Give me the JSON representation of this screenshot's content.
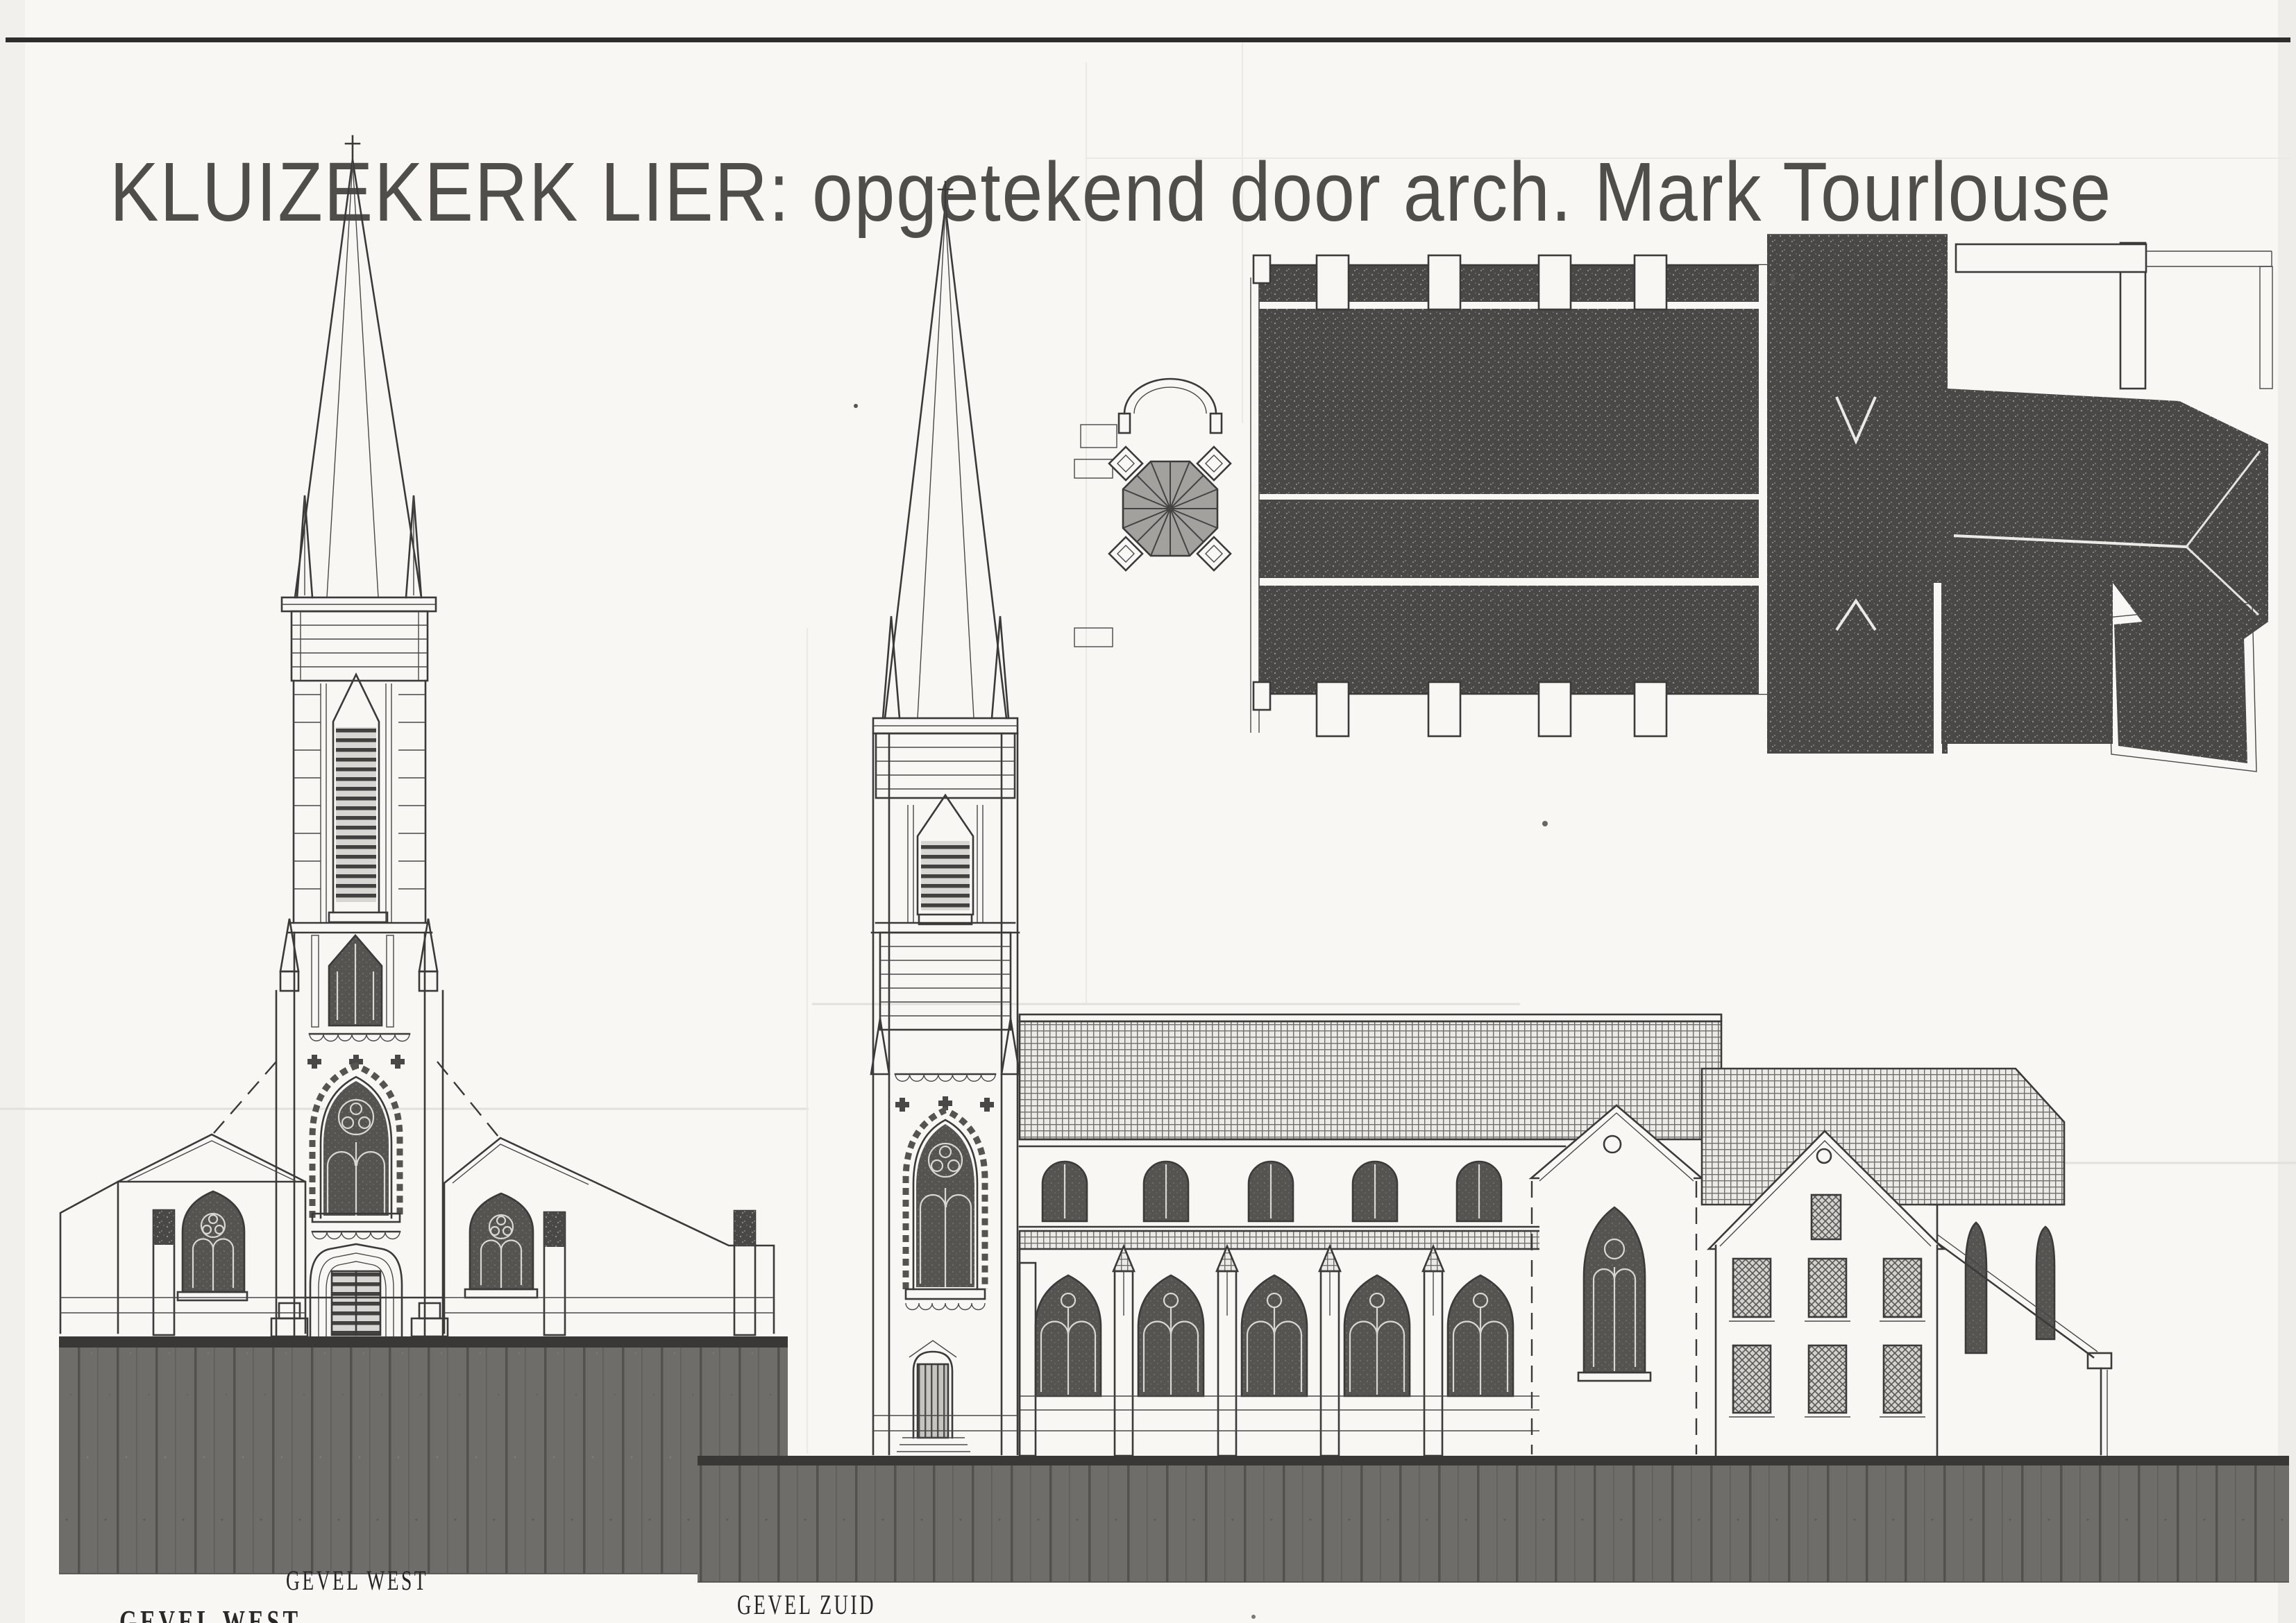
{
  "doc": {
    "title": "KLUIZEKERK LIER: opgetekend door arch. Mark Tourlouse",
    "labels": {
      "west": "GEVEL  WEST",
      "south": "GEVEL ZUID",
      "cutoff": "GEVEL WEST"
    },
    "colors": {
      "ink": "#3b3a38",
      "paper": "#f8f7f4",
      "roof-dark": "#4a4847",
      "ground": "#6f6d6a"
    }
  }
}
